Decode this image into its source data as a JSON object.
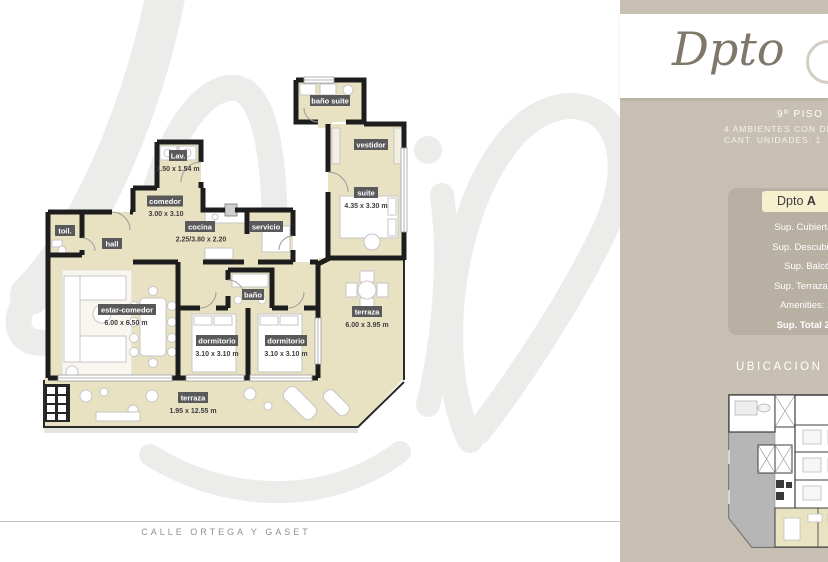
{
  "plan": {
    "street_label": "CALLE ORTEGA Y GASET",
    "colors": {
      "room_fill": "#e9e2c2",
      "wall": "#1d1d1e",
      "label_badge": "#59595b",
      "dim_text": "#3c3c3e",
      "watermark": "#ececea"
    },
    "rooms": [
      {
        "label": "baño suite",
        "dims": ""
      },
      {
        "label": "Lav.",
        "dims": "1.50 x 1.54 m"
      },
      {
        "label": "vestidor",
        "dims": ""
      },
      {
        "label": "suite",
        "dims": "4.35 x 3.30 m"
      },
      {
        "label": "comedor",
        "dims": "3.00 x 3.10"
      },
      {
        "label": "cocina",
        "dims": "2.25/3.80 x 2.20"
      },
      {
        "label": "servicio",
        "dims": ""
      },
      {
        "label": "toil.",
        "dims": ""
      },
      {
        "label": "hall",
        "dims": ""
      },
      {
        "label": "estar-comedor",
        "dims": "6.00 x 6.50 m"
      },
      {
        "label": "baño",
        "dims": ""
      },
      {
        "label": "dormitorio",
        "dims": "3.10 x 3.10 m"
      },
      {
        "label": "dormitorio",
        "dims": "3.10 x 3.10 m"
      },
      {
        "label": "terraza",
        "dims": "6.00 x 3.95 m"
      },
      {
        "label": "terraza",
        "dims": "1.95 x 12.55 m"
      }
    ]
  },
  "sidebar": {
    "accent": "#c7c0b2",
    "title_script": "Dpto",
    "floor": "9º PISO",
    "description": "4 AMBIENTES CON DEPE",
    "units_count": "CANT. UNIDADES: 1",
    "card": {
      "badge_name": "Dpto",
      "badge_unit": "A",
      "badge_bg": "#f7f0cf",
      "lines": [
        "Sup. Cubierta: 155",
        "Sup. Descubierta: 2",
        "Sup. Balcón: -",
        "Sup. Terraza: 25 m",
        "Amenities: 12 m"
      ],
      "total_line": "Sup. Total 220 m"
    },
    "location_heading": "UBICACION EN PL"
  }
}
